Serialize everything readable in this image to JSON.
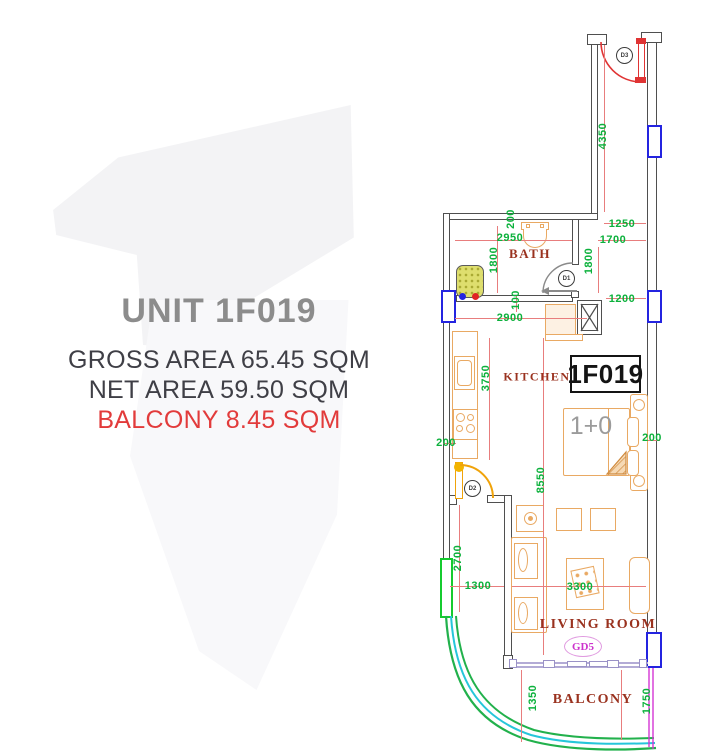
{
  "panel": {
    "unit_title": "UNIT 1F019",
    "gross_area": "GROSS AREA 65.45 SQM",
    "net_area": "NET AREA 59.50 SQM",
    "balcony_area": "BALCONY 8.45 SQM"
  },
  "plan": {
    "unit_label": "1F019",
    "bed_label": "1+0",
    "balcony_door_label": "GD5",
    "doors": [
      "D3",
      "D1",
      "D2"
    ],
    "rooms": [
      {
        "name": "BATH",
        "x": 530,
        "y": 254,
        "size": 13
      },
      {
        "name": "KITCHEN",
        "x": 537,
        "y": 377,
        "size": 12
      },
      {
        "name": "LIVING ROOM",
        "x": 598,
        "y": 625,
        "size": 14
      },
      {
        "name": "BALCONY",
        "x": 593,
        "y": 700,
        "size": 14
      }
    ],
    "dimensions": [
      {
        "text": "4350",
        "x": 603,
        "y": 136,
        "vert": true
      },
      {
        "text": "200",
        "x": 511,
        "y": 219,
        "vert": true
      },
      {
        "text": "1250",
        "x": 622,
        "y": 224,
        "vert": false
      },
      {
        "text": "2950",
        "x": 510,
        "y": 238,
        "vert": false
      },
      {
        "text": "1700",
        "x": 613,
        "y": 240,
        "vert": false
      },
      {
        "text": "1800",
        "x": 494,
        "y": 260,
        "vert": true
      },
      {
        "text": "1800",
        "x": 589,
        "y": 261,
        "vert": true
      },
      {
        "text": "1200",
        "x": 622,
        "y": 299,
        "vert": false
      },
      {
        "text": "100",
        "x": 516,
        "y": 300,
        "vert": true
      },
      {
        "text": "2900",
        "x": 510,
        "y": 318,
        "vert": false
      },
      {
        "text": "3750",
        "x": 486,
        "y": 378,
        "vert": true
      },
      {
        "text": "200",
        "x": 446,
        "y": 443,
        "vert": false
      },
      {
        "text": "200",
        "x": 652,
        "y": 438,
        "vert": false
      },
      {
        "text": "8550",
        "x": 541,
        "y": 480,
        "vert": true
      },
      {
        "text": "2700",
        "x": 458,
        "y": 558,
        "vert": true
      },
      {
        "text": "1300",
        "x": 478,
        "y": 586,
        "vert": false
      },
      {
        "text": "3300",
        "x": 580,
        "y": 587,
        "vert": false
      },
      {
        "text": "1350",
        "x": 533,
        "y": 698,
        "vert": true
      },
      {
        "text": "1750",
        "x": 647,
        "y": 701,
        "vert": true
      }
    ],
    "dim_lines": [
      {
        "x": 604,
        "y": 45,
        "w": 1,
        "h": 167
      },
      {
        "x": 604,
        "y": 223,
        "w": 42,
        "h": 1
      },
      {
        "x": 598,
        "y": 240,
        "w": 48,
        "h": 1
      },
      {
        "x": 598,
        "y": 247,
        "w": 1,
        "h": 46
      },
      {
        "x": 606,
        "y": 298,
        "w": 40,
        "h": 1
      },
      {
        "x": 455,
        "y": 240,
        "w": 117,
        "h": 1
      },
      {
        "x": 497,
        "y": 226,
        "w": 1,
        "h": 67
      },
      {
        "x": 516,
        "y": 296,
        "w": 1,
        "h": 16
      },
      {
        "x": 455,
        "y": 318,
        "w": 132,
        "h": 1
      },
      {
        "x": 489,
        "y": 338,
        "w": 1,
        "h": 122
      },
      {
        "x": 543,
        "y": 338,
        "w": 1,
        "h": 317
      },
      {
        "x": 443,
        "y": 443,
        "w": 13,
        "h": 1
      },
      {
        "x": 646,
        "y": 440,
        "w": 14,
        "h": 1
      },
      {
        "x": 459,
        "y": 505,
        "w": 1,
        "h": 107
      },
      {
        "x": 450,
        "y": 586,
        "w": 54,
        "h": 1
      },
      {
        "x": 512,
        "y": 586,
        "w": 134,
        "h": 1
      },
      {
        "x": 521,
        "y": 670,
        "w": 1,
        "h": 72
      },
      {
        "x": 621,
        "y": 670,
        "w": 1,
        "h": 70
      }
    ],
    "colors": {
      "dim_green": "#0cb13c",
      "dim_line_red": "#e87d7d",
      "wall": "#4f4f4f",
      "window_blue": "#2424e0",
      "window_green": "#15cb2f",
      "railing_green": "#22b14c",
      "railing_cyan": "#26c6da",
      "balcony_magenta": "#d435d4",
      "furniture_orange": "#e9a963",
      "door_red": "#e03434",
      "door_yellow": "#f0a30a",
      "room_label_red": "#9a321f"
    }
  }
}
